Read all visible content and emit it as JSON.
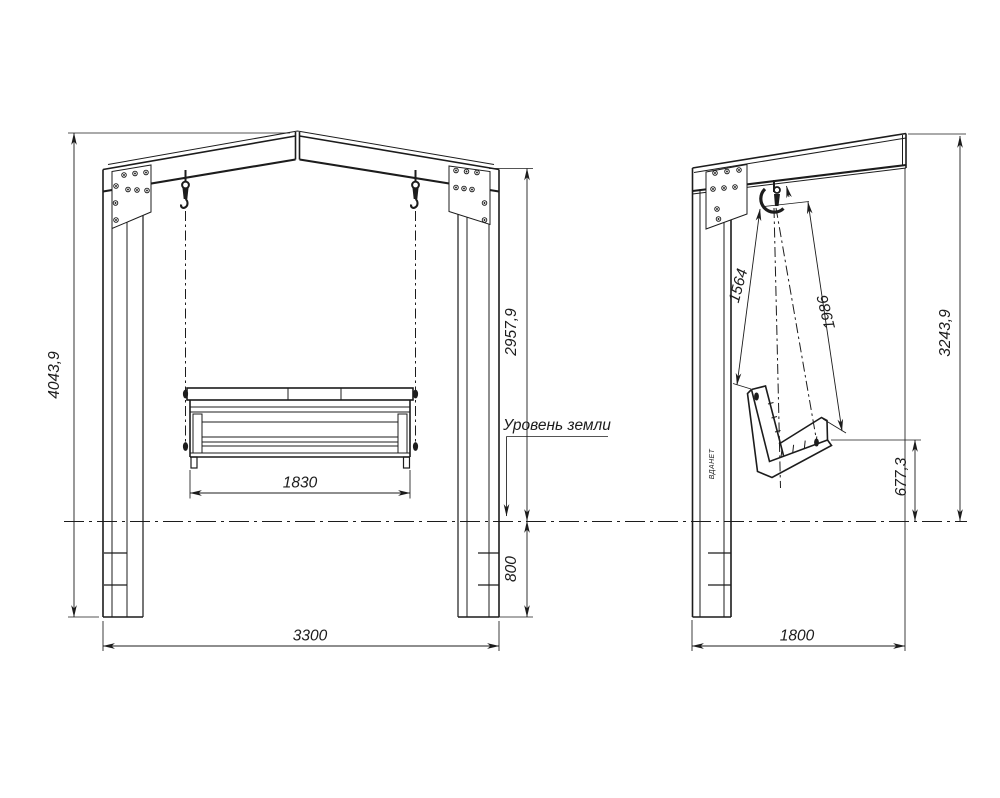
{
  "colors": {
    "background": "#ffffff",
    "line": "#1c1c1c"
  },
  "front_view": {
    "ground_label": "Уровень земли",
    "dims": {
      "overall_height": "4043,9",
      "clearance_height": "2957,9",
      "bench_width": "1830",
      "buried_depth": "800",
      "overall_width": "3300"
    }
  },
  "side_view": {
    "dims": {
      "back_chain_length": "1564",
      "front_chain_length": "1986",
      "frame_height": "3243,9",
      "seat_height": "677,3",
      "overall_depth": "1800"
    },
    "post_brand": "ВДАНЕТ"
  }
}
